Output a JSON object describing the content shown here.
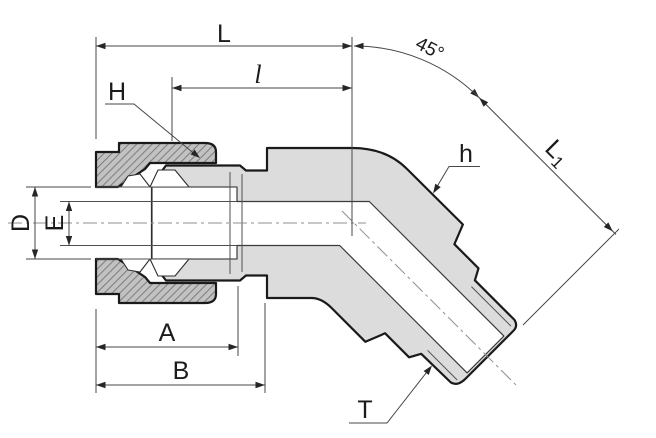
{
  "drawing": {
    "description": "Sectioned technical drawing of a 45-degree male elbow compression tube fitting with nut, ferrules, hex body and tapered male thread"
  },
  "labels": {
    "overall_length": "L",
    "insertion_length": "l",
    "bend_angle": "45°",
    "nut_hex": "H",
    "body_hex": "h",
    "branch_length_main": "L",
    "branch_length_sub": "1",
    "tube_od": "D",
    "bore": "E",
    "length_a": "A",
    "length_b": "B",
    "thread": "T"
  },
  "colors": {
    "bg": "#ffffff",
    "outline": "#1a1a1a",
    "body_fill": "#dcdcdc",
    "nut_fill": "#c2c2c2",
    "hatch": "#7f7f7f",
    "bore_fill": "#ffffff",
    "dim_line": "#474747",
    "centerline": "#8f8f8f",
    "label": "#1b1b1b"
  }
}
